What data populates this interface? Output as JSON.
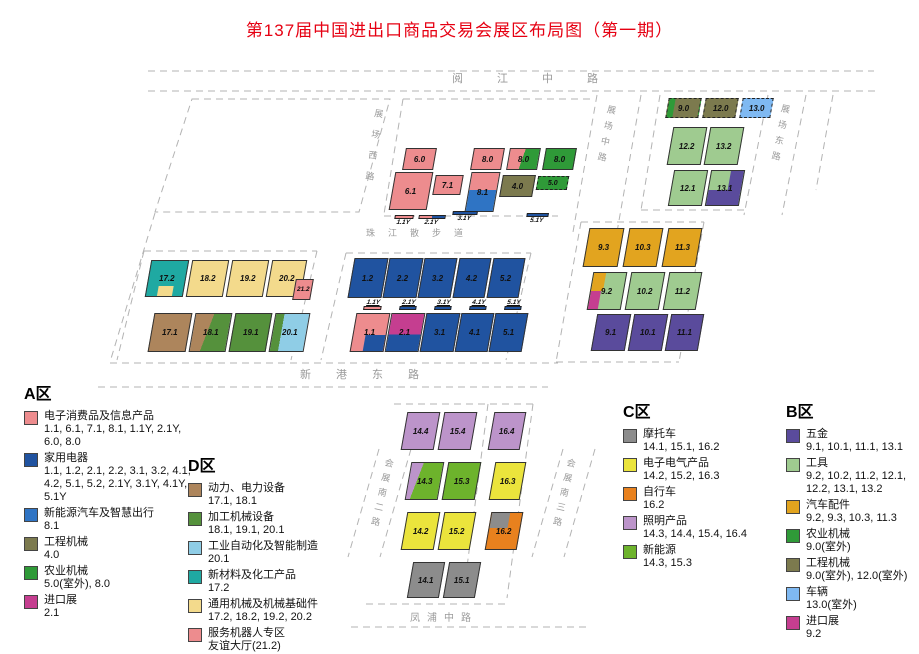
{
  "title": "第137届中国进出口商品交易会展区布局图（第一期）",
  "colors": {
    "titleRed": "#E60012",
    "pink": "#ED8C8E",
    "navy": "#2053A0",
    "midblue": "#2F74C4",
    "olive": "#7C7A4E",
    "agrigreen": "#2F9A38",
    "procgreen": "#55913C",
    "newgreen": "#6DB32C",
    "magenta": "#C53E90",
    "teal": "#1FA9A2",
    "khaki": "#F3DA8C",
    "brown": "#AD855C",
    "autoblue": "#8FCDE6",
    "vehicleblue": "#7FB9F2",
    "amber": "#E2A41F",
    "toolgreen": "#9FCB90",
    "purple": "#5A4B9C",
    "lavender": "#BC94CA",
    "yellow": "#EBE43C",
    "orange": "#E8811E",
    "gray": "#8C8C8C",
    "roadGray": "#9A9A9A"
  },
  "roads": [
    {
      "label": "阅江中路",
      "kind": "h",
      "x": 452,
      "y": 70,
      "ls": 34,
      "fs": 11
    },
    {
      "label": "珠江散步道",
      "kind": "h",
      "x": 366,
      "y": 226,
      "ls": 13,
      "fs": 9
    },
    {
      "label": "新港东路",
      "kind": "h",
      "x": 300,
      "y": 366,
      "ls": 25,
      "fs": 11
    },
    {
      "label": "凤浦中路",
      "kind": "h",
      "x": 410,
      "y": 609,
      "ls": 7,
      "fs": 10
    },
    {
      "label": "展场西路",
      "kind": "v",
      "x": 373,
      "y": 108,
      "ls": 12,
      "fs": 9,
      "rot": 8
    },
    {
      "label": "展场中路",
      "kind": "v",
      "x": 606,
      "y": 104,
      "ls": 7,
      "fs": 9,
      "rot": 11
    },
    {
      "label": "展场东路",
      "kind": "v",
      "x": 780,
      "y": 103,
      "ls": 7,
      "fs": 9,
      "rot": 11
    },
    {
      "label": "会展南二路",
      "kind": "v",
      "x": 384,
      "y": 457,
      "ls": 6,
      "fs": 9,
      "rot": 13
    },
    {
      "label": "会展南三路",
      "kind": "v",
      "x": 566,
      "y": 457,
      "ls": 6,
      "fs": 9,
      "rot": 13
    }
  ],
  "map": {
    "blocks": [
      {
        "label": "6.0",
        "x": 404,
        "y": 148,
        "w": 31,
        "h": 22,
        "c": "pink"
      },
      {
        "label": "8.0",
        "x": 472,
        "y": 148,
        "w": 31,
        "h": 22,
        "c": "pink"
      },
      {
        "label": "8.0",
        "x": 508,
        "y": 148,
        "w": 31,
        "h": 22,
        "g": "linear-gradient(100deg, #ED8C8E 46%, #2F9A38 46%)"
      },
      {
        "label": "8.0",
        "x": 544,
        "y": 148,
        "w": 31,
        "h": 22,
        "c": "agrigreen"
      },
      {
        "label": "6.1",
        "x": 392,
        "y": 172,
        "w": 38,
        "h": 38,
        "c": "pink"
      },
      {
        "label": "7.1",
        "x": 434,
        "y": 175,
        "w": 28,
        "h": 20,
        "c": "pink"
      },
      {
        "label": "8.1",
        "x": 468,
        "y": 172,
        "w": 29,
        "h": 40,
        "g": "linear-gradient(180deg, #ED8C8E 45%, #2F74C4 45%)"
      },
      {
        "label": "4.0",
        "x": 501,
        "y": 175,
        "w": 33,
        "h": 22,
        "c": "olive"
      },
      {
        "label": "5.0",
        "x": 537,
        "y": 176,
        "w": 31,
        "h": 14,
        "c": "agrigreen",
        "outdoor": true,
        "fs": 7
      },
      {
        "label": "9.0",
        "x": 667,
        "y": 98,
        "w": 33,
        "h": 20,
        "g": "linear-gradient(90deg, #2F9A38 20%, #7C7A4E 20%)",
        "outdoor": true
      },
      {
        "label": "12.0",
        "x": 704,
        "y": 98,
        "w": 33,
        "h": 20,
        "c": "olive",
        "outdoor": true
      },
      {
        "label": "13.0",
        "x": 741,
        "y": 98,
        "w": 31,
        "h": 20,
        "c": "vehicleblue",
        "outdoor": true
      },
      {
        "label": "12.2",
        "x": 670,
        "y": 127,
        "w": 34,
        "h": 38,
        "c": "toolgreen"
      },
      {
        "label": "13.2",
        "x": 707,
        "y": 127,
        "w": 34,
        "h": 38,
        "c": "toolgreen"
      },
      {
        "label": "12.1",
        "x": 671,
        "y": 170,
        "w": 34,
        "h": 36,
        "c": "toolgreen"
      },
      {
        "label": "13.1",
        "x": 708,
        "y": 170,
        "w": 34,
        "h": 36,
        "c": "toolgreen",
        "parts": [
          {
            "x": 60,
            "y": 0,
            "w": 40,
            "h": 100,
            "c": "purple"
          },
          {
            "x": 0,
            "y": 56,
            "w": 62,
            "h": 44,
            "c": "purple"
          }
        ]
      },
      {
        "label": "17.2",
        "x": 148,
        "y": 260,
        "w": 38,
        "h": 37,
        "c": "teal",
        "parts": [
          {
            "x": 30,
            "y": 70,
            "w": 42,
            "h": 30,
            "c": "khaki"
          }
        ]
      },
      {
        "label": "18.2",
        "x": 189,
        "y": 260,
        "w": 37,
        "h": 37,
        "c": "khaki"
      },
      {
        "label": "19.2",
        "x": 229,
        "y": 260,
        "w": 37,
        "h": 37,
        "c": "khaki"
      },
      {
        "label": "20.2",
        "x": 269,
        "y": 260,
        "w": 35,
        "h": 37,
        "c": "khaki"
      },
      {
        "label": "21.2",
        "x": 294,
        "y": 279,
        "w": 18,
        "h": 21,
        "c": "pink",
        "fs": 6.5
      },
      {
        "label": "17.1",
        "x": 151,
        "y": 313,
        "w": 38,
        "h": 39,
        "c": "brown"
      },
      {
        "label": "18.1",
        "x": 192,
        "y": 313,
        "w": 37,
        "h": 39,
        "g": "linear-gradient(102deg, #AD855C 42%, #55913C 42%)"
      },
      {
        "label": "19.1",
        "x": 232,
        "y": 313,
        "w": 37,
        "h": 39,
        "c": "procgreen"
      },
      {
        "label": "20.1",
        "x": 272,
        "y": 313,
        "w": 35,
        "h": 39,
        "g": "linear-gradient(90deg, #55913C 25%, #8FCDE6 25%)"
      },
      {
        "label": "1.2",
        "x": 351,
        "y": 258,
        "w": 34,
        "h": 40,
        "c": "navy"
      },
      {
        "label": "2.2",
        "x": 386,
        "y": 258,
        "w": 34,
        "h": 40,
        "c": "navy"
      },
      {
        "label": "3.2",
        "x": 421,
        "y": 258,
        "w": 33,
        "h": 40,
        "c": "navy"
      },
      {
        "label": "4.2",
        "x": 456,
        "y": 258,
        "w": 32,
        "h": 40,
        "c": "navy"
      },
      {
        "label": "5.2",
        "x": 490,
        "y": 258,
        "w": 32,
        "h": 40,
        "c": "navy"
      },
      {
        "label": "1.1",
        "x": 353,
        "y": 313,
        "w": 34,
        "h": 39,
        "c": "pink",
        "parts": [
          {
            "x": 38,
            "y": 56,
            "w": 62,
            "h": 44,
            "c": "navy"
          }
        ]
      },
      {
        "label": "2.1",
        "x": 388,
        "y": 313,
        "w": 34,
        "h": 39,
        "g": "linear-gradient(180deg, #C53E90 55%, #2053A0 55%)"
      },
      {
        "label": "3.1",
        "x": 423,
        "y": 313,
        "w": 34,
        "h": 39,
        "c": "navy"
      },
      {
        "label": "4.1",
        "x": 458,
        "y": 313,
        "w": 33,
        "h": 39,
        "c": "navy"
      },
      {
        "label": "5.1",
        "x": 492,
        "y": 313,
        "w": 33,
        "h": 39,
        "c": "navy"
      },
      {
        "label": "9.3",
        "x": 586,
        "y": 228,
        "w": 35,
        "h": 39,
        "c": "amber"
      },
      {
        "label": "10.3",
        "x": 626,
        "y": 228,
        "w": 34,
        "h": 39,
        "c": "amber"
      },
      {
        "label": "11.3",
        "x": 665,
        "y": 228,
        "w": 34,
        "h": 39,
        "c": "amber"
      },
      {
        "label": "9.2",
        "x": 590,
        "y": 272,
        "w": 34,
        "h": 38,
        "c": "toolgreen",
        "parts": [
          {
            "x": 0,
            "y": 0,
            "w": 36,
            "h": 50,
            "c": "amber"
          },
          {
            "x": 0,
            "y": 50,
            "w": 30,
            "h": 50,
            "c": "magenta"
          }
        ]
      },
      {
        "label": "10.2",
        "x": 628,
        "y": 272,
        "w": 34,
        "h": 38,
        "c": "toolgreen"
      },
      {
        "label": "11.2",
        "x": 666,
        "y": 272,
        "w": 33,
        "h": 38,
        "c": "toolgreen"
      },
      {
        "label": "9.1",
        "x": 594,
        "y": 314,
        "w": 34,
        "h": 37,
        "c": "purple"
      },
      {
        "label": "10.1",
        "x": 631,
        "y": 314,
        "w": 34,
        "h": 37,
        "c": "purple"
      },
      {
        "label": "11.1",
        "x": 668,
        "y": 314,
        "w": 33,
        "h": 37,
        "c": "purple"
      },
      {
        "label": "14.4",
        "x": 404,
        "y": 412,
        "w": 33,
        "h": 38,
        "c": "lavender"
      },
      {
        "label": "15.4",
        "x": 441,
        "y": 412,
        "w": 33,
        "h": 38,
        "c": "lavender"
      },
      {
        "label": "16.4",
        "x": 491,
        "y": 412,
        "w": 32,
        "h": 38,
        "c": "lavender"
      },
      {
        "label": "14.3",
        "x": 408,
        "y": 462,
        "w": 33,
        "h": 38,
        "g": "linear-gradient(102deg, #BC94CA 30%, #6DB32C 30%)"
      },
      {
        "label": "15.3",
        "x": 445,
        "y": 462,
        "w": 33,
        "h": 38,
        "c": "newgreen"
      },
      {
        "label": "16.3",
        "x": 492,
        "y": 462,
        "w": 31,
        "h": 38,
        "c": "yellow"
      },
      {
        "label": "14.2",
        "x": 404,
        "y": 512,
        "w": 33,
        "h": 38,
        "c": "yellow"
      },
      {
        "label": "15.2",
        "x": 441,
        "y": 512,
        "w": 32,
        "h": 38,
        "c": "yellow"
      },
      {
        "label": "16.2",
        "x": 488,
        "y": 512,
        "w": 32,
        "h": 38,
        "c": "orange",
        "parts": [
          {
            "x": 0,
            "y": 0,
            "w": 60,
            "h": 42,
            "c": "gray"
          }
        ]
      },
      {
        "label": "14.1",
        "x": 410,
        "y": 562,
        "w": 32,
        "h": 36,
        "c": "gray"
      },
      {
        "label": "15.1",
        "x": 446,
        "y": 562,
        "w": 32,
        "h": 36,
        "c": "gray"
      }
    ],
    "bars": [
      {
        "label": "1.1Y",
        "x": 394,
        "y": 215,
        "w": 19,
        "bar": "#ED8C8E",
        "lb": "bottom"
      },
      {
        "label": "2.1Y",
        "x": 418,
        "y": 215,
        "w": 27,
        "bar": "linear-gradient(90deg,#ED8C8E 50%,#2053A0 50%)",
        "lb": "bottom"
      },
      {
        "label": "3.1Y",
        "x": 452,
        "y": 211,
        "w": 25,
        "bar": "#2053A0",
        "lb": "bottom"
      },
      {
        "label": "5.1Y",
        "x": 526,
        "y": 213,
        "w": 22,
        "bar": "#2053A0",
        "lb": "bottom"
      },
      {
        "label": "1.1Y",
        "x": 364,
        "y": 299,
        "w": 18,
        "bar": "#ED8C8E",
        "lb": "top"
      },
      {
        "label": "2.1Y",
        "x": 400,
        "y": 299,
        "w": 17,
        "bar": "#2053A0",
        "lb": "top"
      },
      {
        "label": "3.1Y",
        "x": 435,
        "y": 299,
        "w": 17,
        "bar": "#2053A0",
        "lb": "top"
      },
      {
        "label": "4.1Y",
        "x": 470,
        "y": 299,
        "w": 17,
        "bar": "#2053A0",
        "lb": "top"
      },
      {
        "label": "5.1Y",
        "x": 505,
        "y": 299,
        "w": 17,
        "bar": "#2053A0",
        "lb": "top"
      }
    ]
  },
  "legends": [
    {
      "title": "A区",
      "x": 24,
      "y": 380,
      "w": 172,
      "items": [
        {
          "c": "pink",
          "name": "电子消费品及信息产品",
          "nums": "1.1, 6.1, 7.1, 8.1, 1.1Y, 2.1Y, 6.0, 8.0"
        },
        {
          "c": "navy",
          "name": "家用电器",
          "nums": "1.1, 1.2, 2.1, 2.2, 3.1, 3.2, 4.1, 4.2, 5.1, 5.2, 2.1Y, 3.1Y, 4.1Y, 5.1Y"
        },
        {
          "c": "midblue",
          "name": "新能源汽车及智慧出行",
          "nums": "8.1"
        },
        {
          "c": "olive",
          "name": "工程机械",
          "nums": "4.0"
        },
        {
          "c": "agrigreen",
          "name": "农业机械",
          "nums": "5.0(室外), 8.0"
        },
        {
          "c": "magenta",
          "name": "进口展",
          "nums": "2.1"
        }
      ]
    },
    {
      "title": "D区",
      "x": 188,
      "y": 452,
      "w": 192,
      "items": [
        {
          "c": "brown",
          "name": "动力、电力设备",
          "nums": "17.1, 18.1"
        },
        {
          "c": "procgreen",
          "name": "加工机械设备",
          "nums": "18.1, 19.1, 20.1"
        },
        {
          "c": "autoblue",
          "name": "工业自动化及智能制造",
          "nums": "20.1"
        },
        {
          "c": "teal",
          "name": "新材料及化工产品",
          "nums": "17.2"
        },
        {
          "c": "khaki",
          "name": "通用机械及机械基础件",
          "nums": "17.2, 18.2, 19.2, 20.2"
        },
        {
          "c": "pink",
          "name": "服务机器人专区",
          "nums": "友谊大厅(21.2)"
        }
      ]
    },
    {
      "title": "C区",
      "x": 623,
      "y": 398,
      "w": 160,
      "items": [
        {
          "c": "gray",
          "name": "摩托车",
          "nums": "14.1, 15.1, 16.2"
        },
        {
          "c": "yellow",
          "name": "电子电气产品",
          "nums": "14.2, 15.2, 16.3"
        },
        {
          "c": "orange",
          "name": "自行车",
          "nums": "16.2"
        },
        {
          "c": "lavender",
          "name": "照明产品",
          "nums": "14.3, 14.4, 15.4, 16.4"
        },
        {
          "c": "newgreen",
          "name": "新能源",
          "nums": "14.3, 15.3"
        }
      ]
    },
    {
      "title": "B区",
      "x": 786,
      "y": 398,
      "w": 132,
      "items": [
        {
          "c": "purple",
          "name": "五金",
          "nums": "9.1, 10.1, 11.1, 13.1"
        },
        {
          "c": "toolgreen",
          "name": "工具",
          "nums": "9.2, 10.2, 11.2, 12.1, 12.2, 13.1, 13.2"
        },
        {
          "c": "amber",
          "name": "汽车配件",
          "nums": "9.2, 9.3, 10.3, 11.3"
        },
        {
          "c": "agrigreen",
          "name": "农业机械",
          "nums": "9.0(室外)"
        },
        {
          "c": "olive",
          "name": "工程机械",
          "nums": "9.0(室外), 12.0(室外)"
        },
        {
          "c": "vehicleblue",
          "name": "车辆",
          "nums": "13.0(室外)"
        },
        {
          "c": "magenta",
          "name": "进口展",
          "nums": "9.2"
        }
      ]
    }
  ]
}
